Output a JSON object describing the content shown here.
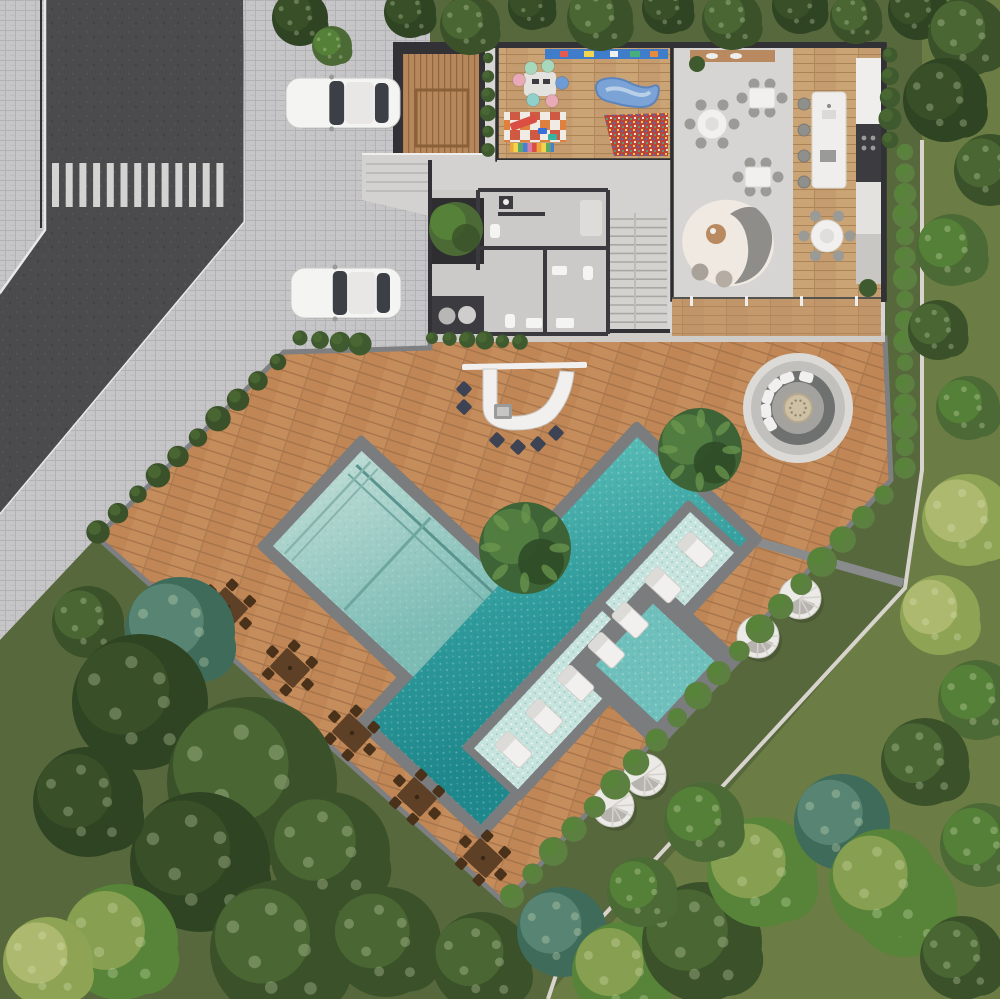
{
  "title": "aerial-site-plan-render",
  "palette": {
    "lawn": "#57683c",
    "lawn_right": "#6b7d45",
    "asphalt": "#4b4b4d",
    "curb": "#e9e8e6",
    "paver": "#c6c5c7",
    "paver_line": "#aeadaf",
    "deck": "#c08655",
    "deck_line": "#a5734a",
    "deck_hi": "#cf9866",
    "coping": "#7b7c7e",
    "pool_edge": "#8a8b8d",
    "water_main_1": "#4fb5b0",
    "water_main_2": "#1e888c",
    "water_shallow_1": "#b6d8d1",
    "water_shallow_2": "#7cbcb5",
    "water_stripe": "#5a948f",
    "ledge": "#c7e3dd",
    "spa_water": "#6fc0bc",
    "house_floor": "#d8d6d4",
    "concrete": "#d3d2d0",
    "wall_dark": "#313136",
    "wood": "#c49c6f",
    "wood_line": "#ab8355",
    "wood_terrace": "#b98a5f",
    "white": "#f1f0ee",
    "chair_gray": "#9a9a96",
    "stool_navy": "#3d4352",
    "island_white": "#efeeec",
    "shelf_blue": "#3f7dcb",
    "kidney_blue": "#7ba3d6",
    "ballpit_base": "#bb4438",
    "mat_orange": "#e0803f",
    "mat_white": "#f0ebe4",
    "hedge": "#3f5a2e",
    "hedge_bright": "#5c8040",
    "tree_dark": "#3a5129",
    "tree_darker": "#2f4423",
    "tree_mid": "#4c6a35",
    "tree_teal": "#3f6b5b",
    "tree_bright": "#578438",
    "tree_light": "#8fa355",
    "tree_yellow": "#b3bd74",
    "furn_brown": "#5e4026",
    "furn_brown_dark": "#4a3119",
    "fire_ring_outer": "#dcdad6",
    "fire_ring_mid": "#c2c0bc",
    "fire_bench": "#6e7170",
    "fire_floor": "#a3a29e",
    "fire_table": "#cdc0a4",
    "car_body": "#f4f4f3",
    "car_glass": "#3c3f45"
  },
  "scene": {
    "summary": "Top-down 3D architectural render: corner street with crosswalk, paver driveway with two white cars, single-family house (playroom, dining hall, kitchen, bathrooms, stairs), timber pool deck with curved bar, sunken fire-pit lounge, L-shaped pool with tanning ledges, square spa, sun loungers, round daybeds, five timber dining sets, lawns and dense trees.",
    "crosswalk": {
      "x0": 52,
      "y": 163,
      "stripe_w": 7,
      "stripe_h": 44,
      "step": 13.7,
      "count": 13
    },
    "cars": [
      {
        "x": 286,
        "y": 78,
        "w": 114,
        "h": 50,
        "label": "white-car-top"
      },
      {
        "x": 291,
        "y": 268,
        "w": 110,
        "h": 50,
        "label": "white-car-bottom"
      }
    ],
    "pool": {
      "angle": 43,
      "origin": [
        637,
        437
      ],
      "main_w": 150,
      "main_l": 390,
      "arm": [
        -204,
        186,
        216,
        154
      ],
      "arm_water": [
        -192,
        198,
        192,
        130
      ],
      "spa_center": [
        655,
        663
      ],
      "spa_half_outer": 62,
      "spa_half_water": 42
    },
    "lounger_strips": [
      {
        "cx": 663,
        "cy": 585,
        "rot": 43,
        "ys": [
          -48,
          0,
          48
        ],
        "note": "three sunbeds on ledge"
      },
      {
        "cx": 560,
        "cy": 700,
        "rot": 43,
        "ys": [
          -68,
          -23,
          23,
          68
        ],
        "note": "four sunbeds on ledge"
      }
    ],
    "pool_plants": [
      {
        "x": 525,
        "y": 548,
        "r": 46
      },
      {
        "x": 700,
        "y": 450,
        "r": 42
      }
    ],
    "bar": {
      "beam": [
        462,
        363,
        125,
        6
      ],
      "stools": [
        [
          464,
          389
        ],
        [
          464,
          407
        ],
        [
          497,
          440
        ],
        [
          518,
          447
        ],
        [
          538,
          444
        ],
        [
          556,
          433
        ]
      ]
    },
    "fire_pit": {
      "cx": 798,
      "cy": 408,
      "r_outer": 55,
      "r_mid": 47,
      "r_bench": 37,
      "r_floor": 26,
      "r_table": 14,
      "cushion_angles": [
        150,
        175,
        200,
        225,
        250,
        285
      ]
    },
    "poufs": [
      [
        800,
        598
      ],
      [
        758,
        637
      ],
      [
        645,
        775
      ],
      [
        613,
        806
      ]
    ],
    "dining_sets": {
      "rot": 43,
      "positions": [
        [
          228,
          607
        ],
        [
          290,
          668
        ],
        [
          352,
          733
        ],
        [
          417,
          797
        ],
        [
          483,
          858
        ]
      ]
    },
    "house_tables": [
      {
        "x": 712,
        "y": 124,
        "shape": "round",
        "r": 15
      },
      {
        "x": 762,
        "y": 98,
        "shape": "rect",
        "w": 26,
        "h": 20
      },
      {
        "x": 758,
        "y": 177,
        "shape": "rect",
        "w": 26,
        "h": 20
      },
      {
        "x": 827,
        "y": 236,
        "shape": "round",
        "r": 16
      }
    ],
    "kitchen_stools": {
      "x": 804,
      "ys": [
        104,
        130,
        156,
        182
      ]
    },
    "play_poufs": [
      {
        "x": 531,
        "y": 68,
        "c": "#a8d8bc"
      },
      {
        "x": 548,
        "y": 66,
        "c": "#a8d8bc"
      },
      {
        "x": 519,
        "y": 80,
        "c": "#e8aab6"
      },
      {
        "x": 562,
        "y": 83,
        "c": "#6d9bd8"
      },
      {
        "x": 533,
        "y": 100,
        "c": "#8fd0cd"
      },
      {
        "x": 552,
        "y": 101,
        "c": "#e8aab6"
      }
    ],
    "hedgerows": [
      {
        "x1": 278,
        "y1": 362,
        "x2": 98,
        "y2": 532,
        "n": 10,
        "r": 11,
        "c": "tree_dark",
        "h": "tree_mid"
      },
      {
        "x1": 905,
        "y1": 152,
        "x2": 905,
        "y2": 468,
        "n": 16,
        "r": 11,
        "c": "hedge_bright",
        "h": "tree_bright"
      },
      {
        "x1": 884,
        "y1": 495,
        "x2": 512,
        "y2": 896,
        "n": 19,
        "r": 13,
        "c": "hedge_bright",
        "h": "tree_bright"
      },
      {
        "x1": 890,
        "y1": 55,
        "x2": 890,
        "y2": 140,
        "n": 5,
        "r": 10,
        "c": "hedge",
        "h": "tree_mid"
      },
      {
        "x1": 300,
        "y1": 338,
        "x2": 360,
        "y2": 344,
        "n": 4,
        "r": 10,
        "c": "hedge",
        "h": "tree_mid"
      },
      {
        "x1": 432,
        "y1": 338,
        "x2": 520,
        "y2": 342,
        "n": 6,
        "r": 8,
        "c": "hedge",
        "h": "tree_mid"
      },
      {
        "x1": 488,
        "y1": 58,
        "x2": 488,
        "y2": 150,
        "n": 6,
        "r": 7,
        "c": "hedge",
        "h": "tree_mid"
      }
    ],
    "trees": [
      {
        "x": 410,
        "y": 12,
        "r": 26,
        "c": "tree_darker",
        "h": "tree_dark"
      },
      {
        "x": 470,
        "y": 25,
        "r": 30,
        "c": "tree_dark",
        "h": "tree_mid"
      },
      {
        "x": 532,
        "y": 6,
        "r": 24,
        "c": "tree_darker",
        "h": "tree_dark"
      },
      {
        "x": 600,
        "y": 18,
        "r": 33,
        "c": "tree_dark",
        "h": "tree_mid"
      },
      {
        "x": 668,
        "y": 8,
        "r": 26,
        "c": "tree_darker",
        "h": "tree_dark"
      },
      {
        "x": 732,
        "y": 20,
        "r": 30,
        "c": "tree_dark",
        "h": "tree_mid"
      },
      {
        "x": 800,
        "y": 6,
        "r": 28,
        "c": "tree_darker",
        "h": "tree_dark"
      },
      {
        "x": 856,
        "y": 18,
        "r": 26,
        "c": "tree_dark",
        "h": "tree_mid"
      },
      {
        "x": 918,
        "y": 10,
        "r": 30,
        "c": "tree_darker",
        "h": "tree_dark"
      },
      {
        "x": 968,
        "y": 36,
        "r": 40,
        "c": "tree_dark",
        "h": "tree_mid"
      },
      {
        "x": 945,
        "y": 100,
        "r": 42,
        "c": "tree_darker",
        "h": "tree_dark"
      },
      {
        "x": 990,
        "y": 170,
        "r": 36,
        "c": "tree_dark",
        "h": "tree_mid"
      },
      {
        "x": 952,
        "y": 250,
        "r": 36,
        "c": "tree_mid",
        "h": "tree_bright"
      },
      {
        "x": 938,
        "y": 330,
        "r": 30,
        "c": "tree_dark",
        "h": "tree_mid"
      },
      {
        "x": 968,
        "y": 408,
        "r": 32,
        "c": "tree_mid",
        "h": "tree_bright"
      },
      {
        "x": 968,
        "y": 520,
        "r": 46,
        "c": "tree_light",
        "h": "tree_yellow"
      },
      {
        "x": 940,
        "y": 615,
        "r": 40,
        "c": "tree_light",
        "h": "tree_yellow"
      },
      {
        "x": 978,
        "y": 700,
        "r": 40,
        "c": "tree_mid",
        "h": "tree_bright"
      },
      {
        "x": 925,
        "y": 762,
        "r": 44,
        "c": "tree_dark",
        "h": "tree_mid"
      },
      {
        "x": 982,
        "y": 845,
        "r": 42,
        "c": "tree_mid",
        "h": "tree_bright"
      },
      {
        "x": 905,
        "y": 905,
        "r": 52,
        "c": "tree_bright",
        "h": "tree_light"
      },
      {
        "x": 962,
        "y": 958,
        "r": 42,
        "c": "tree_dark",
        "h": "tree_mid"
      },
      {
        "x": 300,
        "y": 18,
        "r": 28,
        "c": "tree_darker",
        "h": "tree_dark"
      },
      {
        "x": 332,
        "y": 46,
        "r": 20,
        "c": "tree_mid",
        "h": "tree_bright"
      },
      {
        "x": 180,
        "y": 632,
        "r": 55,
        "c": "tree_teal",
        "h": "#5d8a78"
      },
      {
        "x": 88,
        "y": 622,
        "r": 36,
        "c": "tree_dark",
        "h": "tree_mid"
      },
      {
        "x": 140,
        "y": 702,
        "r": 68,
        "c": "tree_darker",
        "h": "tree_dark"
      },
      {
        "x": 252,
        "y": 782,
        "r": 85,
        "c": "tree_dark",
        "h": "tree_mid"
      },
      {
        "x": 200,
        "y": 862,
        "r": 70,
        "c": "tree_darker",
        "h": "tree_dark"
      },
      {
        "x": 330,
        "y": 852,
        "r": 60,
        "c": "tree_dark",
        "h": "tree_mid"
      },
      {
        "x": 88,
        "y": 802,
        "r": 55,
        "c": "tree_darker",
        "h": "tree_dark"
      },
      {
        "x": 280,
        "y": 950,
        "r": 70,
        "c": "tree_dark",
        "h": "tree_mid"
      },
      {
        "x": 120,
        "y": 942,
        "r": 58,
        "c": "tree_bright",
        "h": "tree_light"
      },
      {
        "x": 48,
        "y": 962,
        "r": 45,
        "c": "tree_light",
        "h": "tree_yellow"
      },
      {
        "x": 386,
        "y": 942,
        "r": 55,
        "c": "tree_dark",
        "h": "tree_mid"
      },
      {
        "x": 482,
        "y": 962,
        "r": 50,
        "c": "tree_dark",
        "h": "tree_mid"
      },
      {
        "x": 562,
        "y": 932,
        "r": 45,
        "c": "tree_teal",
        "h": "#5d8a78"
      },
      {
        "x": 622,
        "y": 972,
        "r": 50,
        "c": "tree_bright",
        "h": "tree_light"
      },
      {
        "x": 702,
        "y": 942,
        "r": 60,
        "c": "tree_dark",
        "h": "tree_mid"
      },
      {
        "x": 762,
        "y": 872,
        "r": 55,
        "c": "tree_bright",
        "h": "tree_light"
      },
      {
        "x": 842,
        "y": 822,
        "r": 48,
        "c": "tree_teal",
        "h": "#5d8a78"
      },
      {
        "x": 884,
        "y": 884,
        "r": 55,
        "c": "tree_bright",
        "h": "tree_light"
      },
      {
        "x": 704,
        "y": 822,
        "r": 40,
        "c": "tree_mid",
        "h": "tree_bright"
      },
      {
        "x": 642,
        "y": 892,
        "r": 35,
        "c": "tree_mid",
        "h": "tree_bright"
      }
    ]
  }
}
